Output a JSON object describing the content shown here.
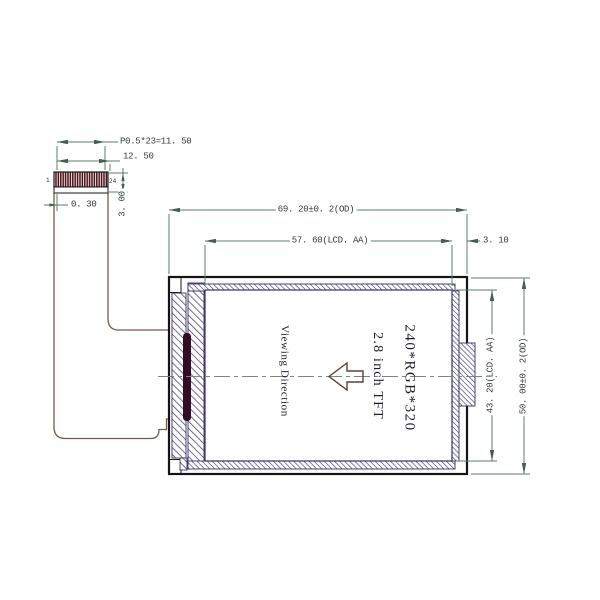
{
  "drawing_title": "2.8 inch TFT LCD module outline drawing",
  "connector": {
    "pin_start": "1",
    "pin_end": "24",
    "dim_pitch": "P0.5*23=11. 50",
    "dim_width": "12. 50",
    "dim_edge_margin": "0. 30",
    "dim_height": "3. 00"
  },
  "module_dims": {
    "outer_width": "69. 20±0. 2(OD)",
    "active_width": "57. 60(LCD. AA)",
    "right_margin": "3. 10",
    "active_height": "43. 20(LCD. AA)",
    "outer_height": "50. 00±0. 2(OD)"
  },
  "panel": {
    "resolution": "240*RGB*320",
    "size_label": "2.8 inch TFT",
    "viewing_label": "Viewing Direction"
  },
  "colors": {
    "dimension_line": "#5d7b6b",
    "dimension_text": "#2f3b33",
    "frame_hatch": "#3d3d72",
    "frame_line": "#3a2f66",
    "connector_hatch": "#481016",
    "cable": "#7a5948",
    "outline": "#141414",
    "driver_ic": "#340c26",
    "centerline": "#76897c",
    "arrow": "#5a4038"
  }
}
